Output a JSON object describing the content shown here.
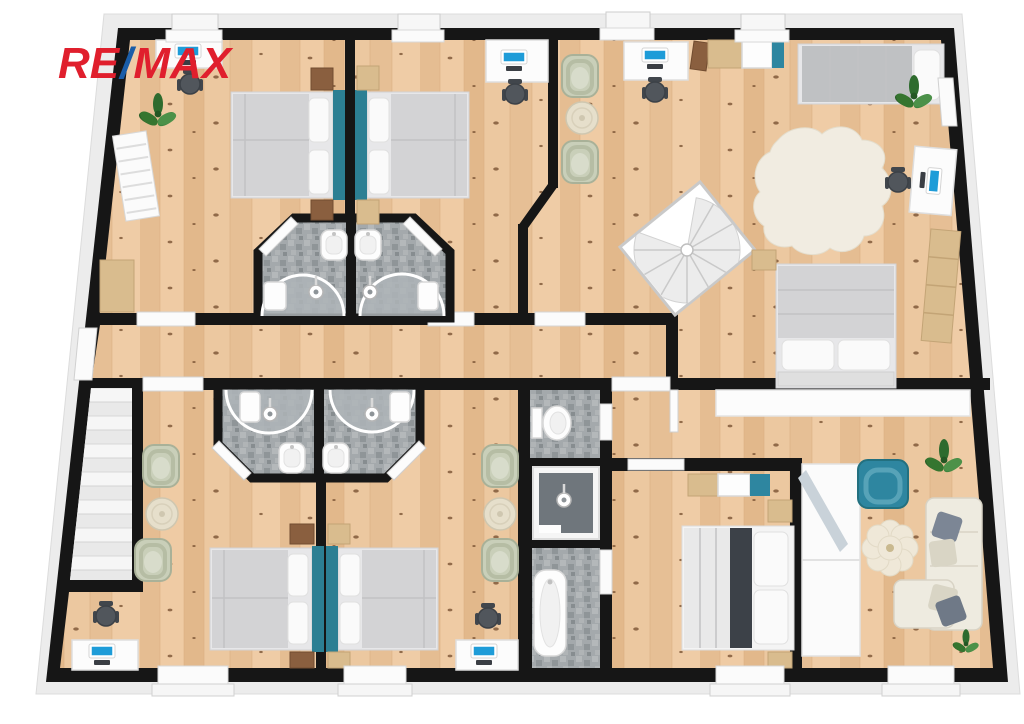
{
  "logo": {
    "part1": "RE",
    "slash": "/",
    "part2": "MAX"
  },
  "colors": {
    "logo_red": "#E01F2D",
    "logo_blue": "#1A5DA8",
    "wall": "#161616",
    "floor_wood": "#E9C49B",
    "tile_gray": "#A4A9AC",
    "accent_teal": "#2E86A0",
    "headboard_teal": "#2C7F93",
    "screen_blue": "#1E9CD8",
    "plant_green": "#3E7D3A",
    "sofa_cream": "#EEEBE0"
  },
  "icons": {
    "double-bed": "rect with pillows and teal headboard",
    "single-bed": "rect with gray blanket and pillow",
    "desk-with-computer": "white rect with blue screen",
    "office-chair": "dark gray circle with armrests",
    "wicker-chair": "sage rounded square",
    "round-table": "cream circle",
    "plant": "green leaf cluster",
    "shower": "curved glass arc on tile",
    "sink": "white rounded basin",
    "toilet": "white bowl with tank",
    "bathtub": "white oval tub",
    "spiral-staircase": "diamond with step fan",
    "staircase": "parallel treads",
    "sofa": "cream L-shape with pillows",
    "armchair": "teal rounded square",
    "cowhide-rug": "cream organic blob",
    "flower-rug": "petal circle cluster",
    "wardrobe": "white strip with mirror band",
    "window": "white break in wall",
    "door": "white sill / leaf"
  }
}
